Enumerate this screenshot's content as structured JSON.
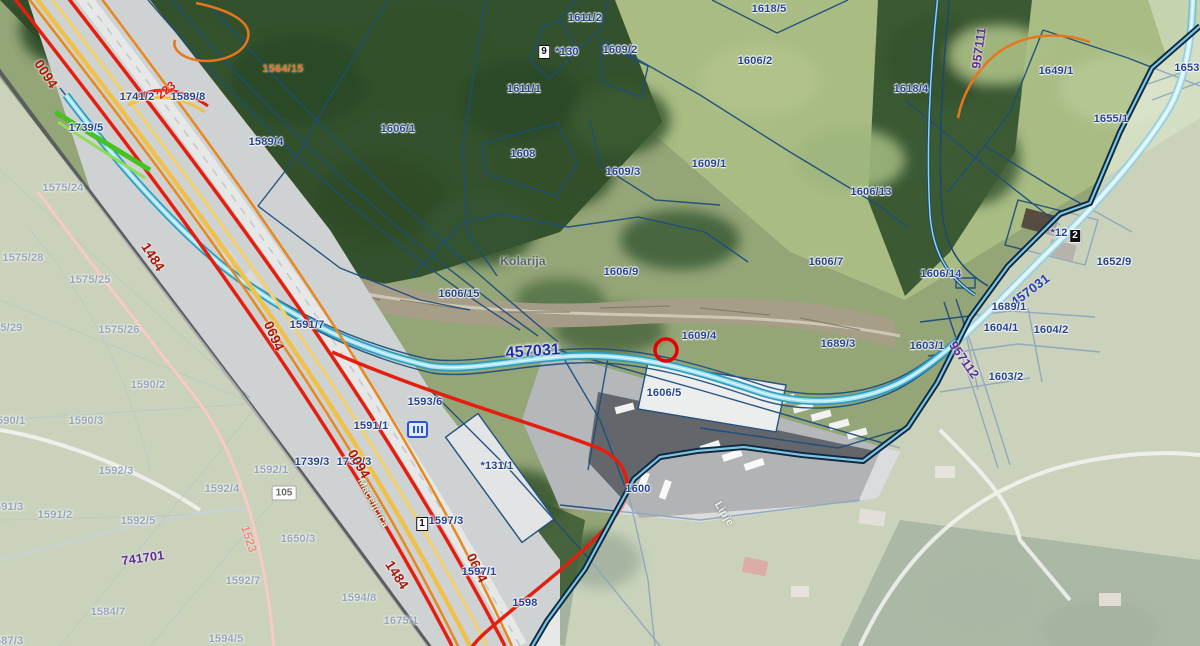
{
  "map": {
    "labels": [
      {
        "t": "0094",
        "x": 46,
        "y": 74,
        "c": "red",
        "r": 57
      },
      {
        "t": "1741/2",
        "x": 137,
        "y": 97,
        "c": "parcel"
      },
      {
        "t": "223",
        "x": 166,
        "y": 90,
        "c": "redbright",
        "r": -38
      },
      {
        "t": "1589/8",
        "x": 188,
        "y": 97,
        "c": "parcel"
      },
      {
        "t": "1739/5",
        "x": 86,
        "y": 128,
        "c": "parcel"
      },
      {
        "t": "1589/4",
        "x": 266,
        "y": 142,
        "c": "parcel"
      },
      {
        "t": "1564/15",
        "x": 283,
        "y": 69,
        "c": "orange"
      },
      {
        "t": "1575/24",
        "x": 63,
        "y": 188,
        "c": "faded"
      },
      {
        "t": "1484",
        "x": 153,
        "y": 257,
        "c": "red",
        "r": 57
      },
      {
        "t": "1575/28",
        "x": 23,
        "y": 258,
        "c": "faded"
      },
      {
        "t": "1575/25",
        "x": 90,
        "y": 280,
        "c": "faded"
      },
      {
        "t": "1575/29",
        "x": 2,
        "y": 328,
        "c": "faded"
      },
      {
        "t": "1575/26",
        "x": 119,
        "y": 330,
        "c": "faded"
      },
      {
        "t": "0694",
        "x": 274,
        "y": 336,
        "c": "red",
        "r": 66
      },
      {
        "t": "1591/7",
        "x": 307,
        "y": 325,
        "c": "parcel"
      },
      {
        "t": "1590/2",
        "x": 148,
        "y": 385,
        "c": "faded"
      },
      {
        "t": "1590/1",
        "x": 8,
        "y": 421,
        "c": "faded"
      },
      {
        "t": "1590/3",
        "x": 86,
        "y": 421,
        "c": "faded"
      },
      {
        "t": "1592/3",
        "x": 116,
        "y": 471,
        "c": "faded"
      },
      {
        "t": "1592/4",
        "x": 222,
        "y": 489,
        "c": "faded"
      },
      {
        "t": "1592/1",
        "x": 271,
        "y": 470,
        "c": "faded"
      },
      {
        "t": "1591/3",
        "x": 6,
        "y": 507,
        "c": "faded"
      },
      {
        "t": "1591/2",
        "x": 55,
        "y": 515,
        "c": "faded"
      },
      {
        "t": "1592/5",
        "x": 138,
        "y": 521,
        "c": "faded"
      },
      {
        "t": "741701",
        "x": 143,
        "y": 558,
        "c": "purple",
        "r": -8
      },
      {
        "t": "1523",
        "x": 249,
        "y": 539,
        "c": "pink",
        "r": 72
      },
      {
        "t": "1592/7",
        "x": 243,
        "y": 581,
        "c": "faded"
      },
      {
        "t": "1584/7",
        "x": 108,
        "y": 612,
        "c": "faded"
      },
      {
        "t": "1587/3",
        "x": 6,
        "y": 641,
        "c": "faded"
      },
      {
        "t": "1594/5",
        "x": 226,
        "y": 639,
        "c": "faded"
      },
      {
        "t": "1650/3",
        "x": 298,
        "y": 539,
        "c": "faded"
      },
      {
        "t": "1594/8",
        "x": 359,
        "y": 598,
        "c": "faded"
      },
      {
        "t": "1675/1",
        "x": 401,
        "y": 621,
        "c": "faded"
      },
      {
        "t": "1611/2",
        "x": 585,
        "y": 18,
        "c": "parcel"
      },
      {
        "t": "*130",
        "x": 567,
        "y": 52,
        "c": "parcel"
      },
      {
        "t": "1611/1",
        "x": 524,
        "y": 89,
        "c": "parcel"
      },
      {
        "t": "1606/1",
        "x": 398,
        "y": 129,
        "c": "parcel"
      },
      {
        "t": "1608",
        "x": 523,
        "y": 154,
        "c": "parcel"
      },
      {
        "t": "1618/5",
        "x": 769,
        "y": 9,
        "c": "parcel"
      },
      {
        "t": "1609/2",
        "x": 620,
        "y": 50,
        "c": "parcel"
      },
      {
        "t": "1606/2",
        "x": 755,
        "y": 61,
        "c": "parcel"
      },
      {
        "t": "1609/3",
        "x": 623,
        "y": 172,
        "c": "parcel"
      },
      {
        "t": "1609/1",
        "x": 709,
        "y": 164,
        "c": "parcel"
      },
      {
        "t": "1606/13",
        "x": 871,
        "y": 192,
        "c": "parcel"
      },
      {
        "t": "1618/4",
        "x": 911,
        "y": 89,
        "c": "parcel"
      },
      {
        "t": "1649/1",
        "x": 1056,
        "y": 71,
        "c": "parcel"
      },
      {
        "t": "1653",
        "x": 1187,
        "y": 68,
        "c": "parcel"
      },
      {
        "t": "1655/1",
        "x": 1111,
        "y": 119,
        "c": "parcel"
      },
      {
        "t": "957111",
        "x": 979,
        "y": 48,
        "c": "purple",
        "r": -82
      },
      {
        "t": "Kolarija",
        "x": 523,
        "y": 261,
        "c": "place"
      },
      {
        "t": "1606/15",
        "x": 459,
        "y": 294,
        "c": "parcel"
      },
      {
        "t": "1606/9",
        "x": 621,
        "y": 272,
        "c": "parcel"
      },
      {
        "t": "1606/7",
        "x": 826,
        "y": 262,
        "c": "parcel"
      },
      {
        "t": "457031",
        "x": 533,
        "y": 352,
        "c": "roadblue",
        "r": -4
      },
      {
        "t": "1609/4",
        "x": 699,
        "y": 336,
        "c": "parcel"
      },
      {
        "t": "1689/3",
        "x": 838,
        "y": 344,
        "c": "parcel"
      },
      {
        "t": "1606/5",
        "x": 664,
        "y": 393,
        "c": "parcel"
      },
      {
        "t": "1606/14",
        "x": 941,
        "y": 274,
        "c": "parcel"
      },
      {
        "t": "457031",
        "x": 1030,
        "y": 290,
        "c": "roadblue2",
        "r": -37
      },
      {
        "t": "1652/9",
        "x": 1114,
        "y": 262,
        "c": "parcel"
      },
      {
        "t": "*12",
        "x": 1059,
        "y": 233,
        "c": "parcel"
      },
      {
        "t": "1689/1",
        "x": 1009,
        "y": 307,
        "c": "parcel"
      },
      {
        "t": "1604/1",
        "x": 1001,
        "y": 328,
        "c": "parcel"
      },
      {
        "t": "1604/2",
        "x": 1051,
        "y": 330,
        "c": "parcel"
      },
      {
        "t": "1603/1",
        "x": 927,
        "y": 346,
        "c": "parcel"
      },
      {
        "t": "1603/2",
        "x": 1006,
        "y": 377,
        "c": "parcel"
      },
      {
        "t": "957112",
        "x": 964,
        "y": 360,
        "c": "purple",
        "r": 55
      },
      {
        "t": "1593/6",
        "x": 425,
        "y": 402,
        "c": "parcel"
      },
      {
        "t": "1591/1",
        "x": 371,
        "y": 426,
        "c": "parcel"
      },
      {
        "t": "1739/3",
        "x": 312,
        "y": 462,
        "c": "parcel"
      },
      {
        "t": "1739/3",
        "x": 354,
        "y": 462,
        "c": "parcel"
      },
      {
        "t": "0094",
        "x": 359,
        "y": 464,
        "c": "red",
        "r": 60
      },
      {
        "t": "*131/1",
        "x": 497,
        "y": 466,
        "c": "parcel"
      },
      {
        "t": "Maceljčica",
        "x": 373,
        "y": 503,
        "c": "street",
        "r": 62
      },
      {
        "t": "1597/3",
        "x": 446,
        "y": 521,
        "c": "parcel"
      },
      {
        "t": "1484",
        "x": 397,
        "y": 575,
        "c": "red",
        "r": 57
      },
      {
        "t": "0694",
        "x": 477,
        "y": 568,
        "c": "red",
        "r": 64
      },
      {
        "t": "1597/1",
        "x": 479,
        "y": 572,
        "c": "parcel"
      },
      {
        "t": "1598",
        "x": 525,
        "y": 603,
        "c": "parcel"
      },
      {
        "t": "1600",
        "x": 638,
        "y": 489,
        "c": "parcel"
      },
      {
        "t": "Lipje",
        "x": 724,
        "y": 514,
        "c": "white",
        "r": 58
      }
    ],
    "badges": [
      {
        "t": "9",
        "x": 544,
        "y": 52,
        "s": "white"
      },
      {
        "t": "1",
        "x": 422,
        "y": 524,
        "s": "white"
      },
      {
        "t": "2",
        "x": 1075,
        "y": 236,
        "s": "black"
      },
      {
        "t": "105",
        "x": 284,
        "y": 493,
        "s": "pill"
      }
    ],
    "marker": {
      "x": 666,
      "y": 350,
      "r": 11
    },
    "palette": {
      "parcel_line": "#1d4e7c",
      "parcel_text": "#23418f",
      "road_red": "#e41f10",
      "road_red_text": "#a81708",
      "road_cyan": "#a5e2f2",
      "road_cyan_casing": "#2f9dbd",
      "road_blue_text": "#1b2fa8",
      "purple_text": "#5b2b94",
      "orange_line": "#e8761c",
      "railway_yellow": "#f0c14a",
      "pink_road": "#f2948a",
      "boundary_dark": "#10293f",
      "boundary_light": "#7cc4e2",
      "selection_red": "#e80000",
      "fade_white": "rgba(255,255,255,0.5)"
    }
  }
}
